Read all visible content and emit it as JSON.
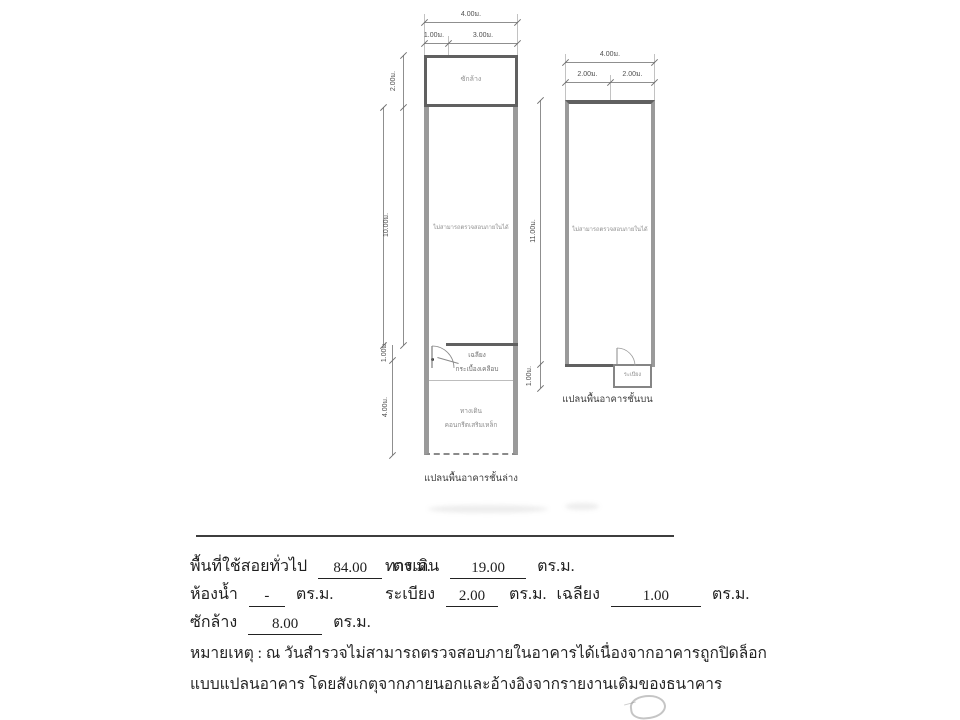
{
  "doc": {
    "colors": {
      "ink": "#222222",
      "wall_dark": "#606060",
      "wall_gray": "#9a9a9a"
    },
    "lower_plan": {
      "caption": "แปลนพื้นอาคารชั้นล่าง",
      "room_top": "ซักล้าง",
      "room_main": "ไม่สามารถตรวจสอบภายในได้",
      "porch_label": "เฉลียง",
      "porch_material": "กระเบื้องเคลือบ",
      "walkway_label": "ทางเดิน",
      "walkway_material": "คอนกรีตเสริมเหล็ก",
      "dim_width_total": "4.00ม.",
      "dim_width_left": "1.00ม.",
      "dim_width_right": "3.00ม.",
      "dim_h_top_room": "2.00ม.",
      "dim_h_main": "10.00ม.",
      "dim_h_porch": "1.00ม.",
      "dim_h_walkway": "4.00ม."
    },
    "upper_plan": {
      "caption": "แปลนพื้นอาคารชั้นบน",
      "room_main": "ไม่สามารถตรวจสอบภายในได้",
      "balcony_label": "ระเบียง",
      "dim_width_total": "4.00ม.",
      "dim_width_left": "2.00ม.",
      "dim_width_right": "2.00ม.",
      "dim_h_main": "11.00ม.",
      "dim_h_balcony": "1.00ม."
    },
    "summary": {
      "general_label": "พื้นที่ใช้สอยทั่วไป",
      "general_value": "84.00",
      "walkway_label": "ทางเดิน",
      "walkway_value": "19.00",
      "bathroom_label": "ห้องน้ำ",
      "bathroom_value": "-",
      "balcony_label": "ระเบียง",
      "balcony_value": "2.00",
      "porch_label": "เฉลียง",
      "porch_value": "1.00",
      "washing_label": "ซักล้าง",
      "washing_value": "8.00",
      "unit": "ตร.ม."
    },
    "notes": {
      "line1": "หมายเหตุ : ณ วันสำรวจไม่สามารถตรวจสอบภายในอาคารได้เนื่องจากอาคารถูกปิดล็อก",
      "line2": "แบบแปลนอาคาร โดยสังเกตุจากภายนอกและอ้างอิงจากรายงานเดิมของธนาคาร"
    }
  }
}
